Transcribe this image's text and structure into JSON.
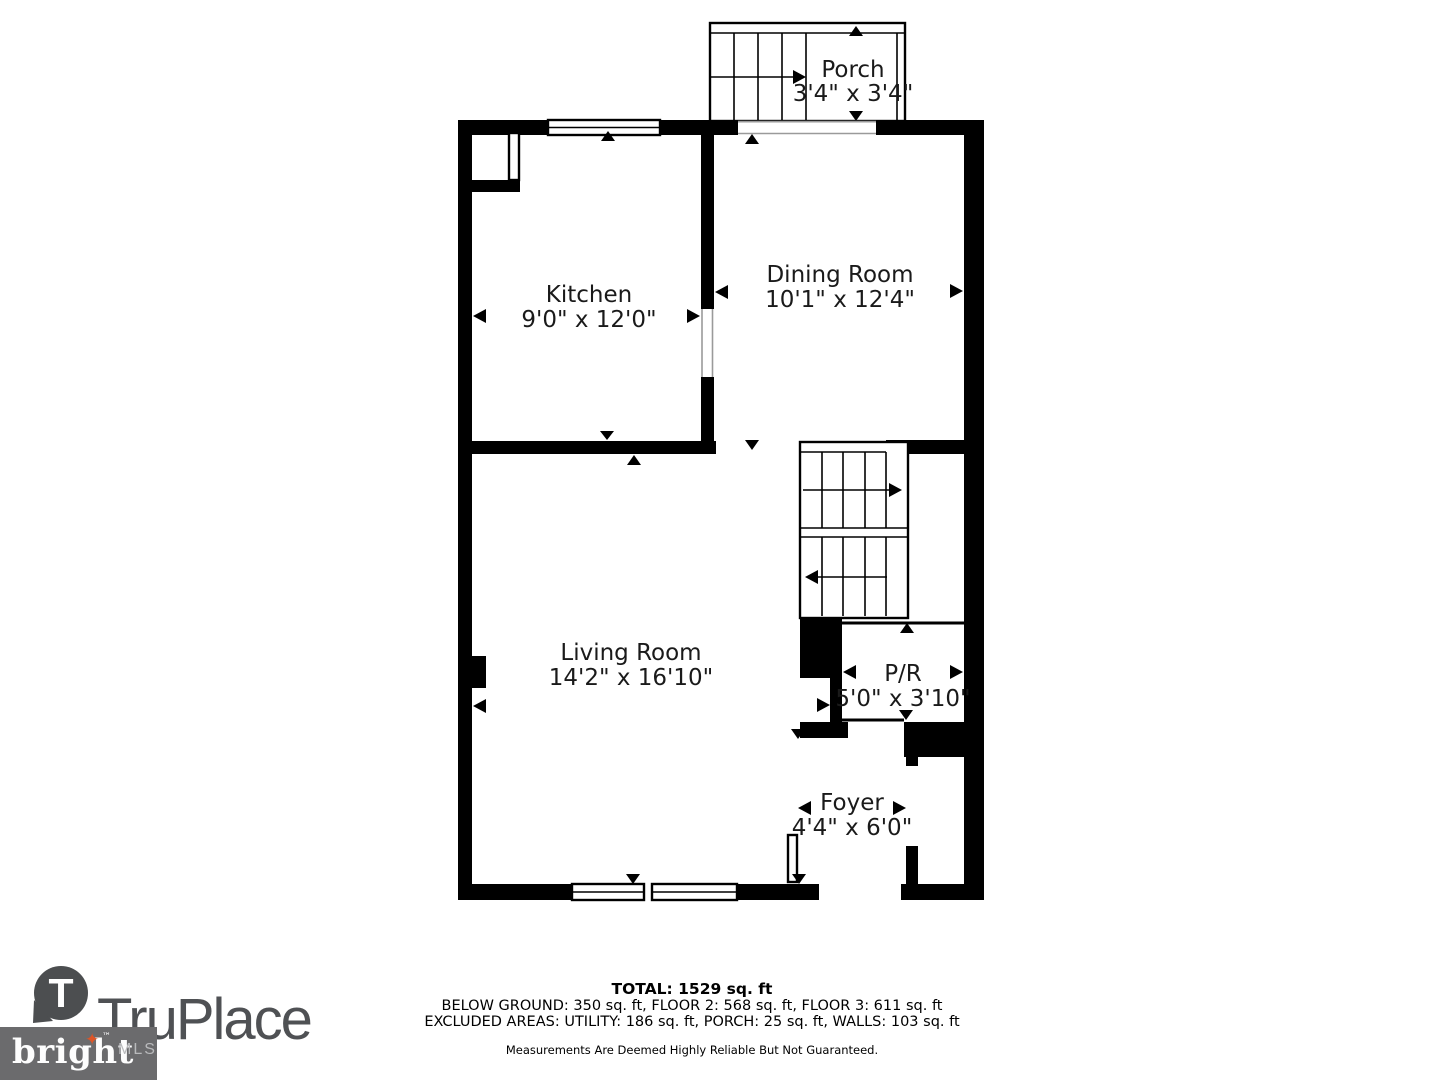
{
  "floorplan": {
    "rooms": {
      "porch": {
        "name": "Porch",
        "dims": "3'4\" x 3'4\""
      },
      "kitchen": {
        "name": "Kitchen",
        "dims": "9'0\" x 12'0\""
      },
      "dining": {
        "name": "Dining Room",
        "dims": "10'1\" x 12'4\""
      },
      "living": {
        "name": "Living Room",
        "dims": "14'2\" x 16'10\""
      },
      "powder": {
        "name": "P/R",
        "dims": "5'0\" x 3'10\""
      },
      "foyer": {
        "name": "Foyer",
        "dims": "4'4\" x 6'0\""
      }
    }
  },
  "footer": {
    "total": "TOTAL: 1529 sq. ft",
    "breakdown": "BELOW GROUND: 350 sq. ft, FLOOR 2: 568 sq. ft, FLOOR 3: 611 sq. ft",
    "excluded": "EXCLUDED AREAS: UTILITY: 186 sq. ft, PORCH: 25 sq. ft, WALLS: 103 sq. ft",
    "disclaimer": "Measurements Are Deemed Highly Reliable But Not Guaranteed."
  },
  "branding": {
    "truplace": {
      "monogram": "T",
      "wordmark": "TruPlace"
    },
    "brightmls": {
      "word": "bright",
      "tm": "™",
      "star": "✦",
      "suffix": "MLS"
    },
    "colors": {
      "logo_gray": "#4f5154",
      "bright_box_gray": "#6b6b6d",
      "star_orange": "#dd5527",
      "mls_text_gray": "#b9babc",
      "wall_black": "#000000"
    }
  }
}
